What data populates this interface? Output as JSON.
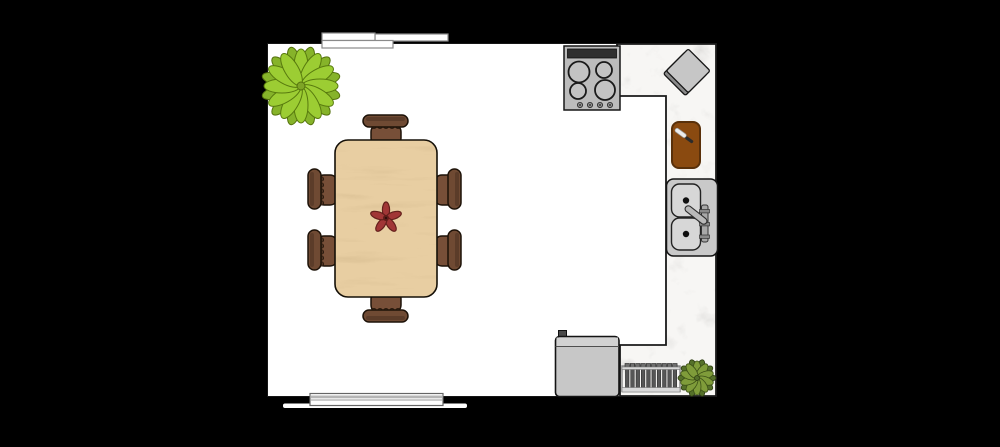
{
  "floorplan": {
    "items": {
      "room": "Kitchen and dining room",
      "top_window": "Window (top wall)",
      "bottom_window": "Window (bottom wall)",
      "countertop": "L-shaped marble countertop",
      "stove": "Four-burner stove",
      "toaster": "Countertop appliance (toaster)",
      "cutting_board": "Cutting board with knife",
      "sink": "Double-basin sink with faucet",
      "refrigerator": "Refrigerator",
      "dish_rack": "Dish drying rack",
      "plant_large": "Large potted plant",
      "plant_small": "Small potted plant",
      "dining_table": "Six-seat wooden dining table",
      "flower": "Flower centerpiece",
      "chair_top": "Dining chair (top)",
      "chair_bottom": "Dining chair (bottom)",
      "chair_left_upper": "Dining chair (left upper)",
      "chair_left_lower": "Dining chair (left lower)",
      "chair_right_upper": "Dining chair (right upper)",
      "chair_right_lower": "Dining chair (right lower)"
    },
    "colors": {
      "background": "#000000",
      "room_floor": "#ffffff",
      "marble": "#f2f0ec",
      "table_wood": "#e0bb7e",
      "chair_brown": "#6f4a33",
      "cutting_board_brown": "#8a4a10",
      "plant_green_light": "#9ccd33",
      "plant_green_olive": "#7f9c3a",
      "appliance_gray": "#c7c7c7",
      "stove_gray": "#bcbcbc",
      "flower_red": "#a13636"
    }
  }
}
